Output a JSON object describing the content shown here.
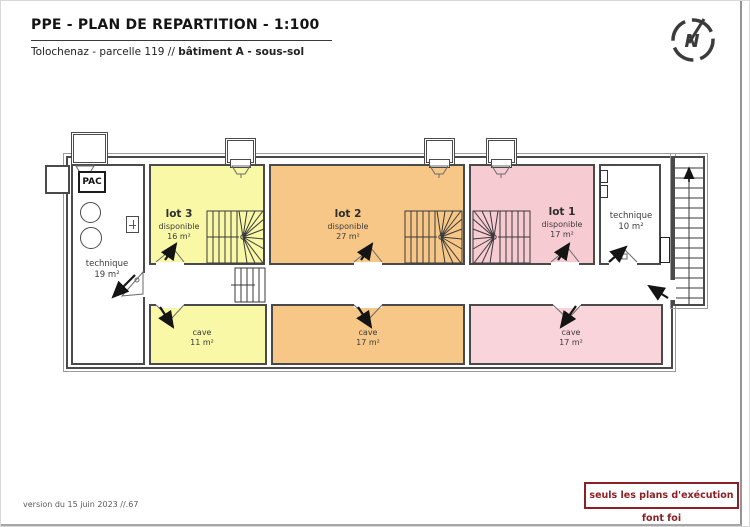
{
  "header": {
    "title": "PPE - PLAN DE REPARTITION - 1:100",
    "subtitle_prefix": "Tolochenaz - parcelle 119 // ",
    "subtitle_bold": "bâtiment A - sous-sol"
  },
  "compass": {
    "letter": "N"
  },
  "plan": {
    "lots": {
      "lot3": {
        "name": "lot 3",
        "status": "disponible",
        "area": "16 m²",
        "color": "#f9f8a6"
      },
      "lot2": {
        "name": "lot 2",
        "status": "disponible",
        "area": "27 m²",
        "color": "#f7c787"
      },
      "lot1": {
        "name": "lot 1",
        "status": "disponible",
        "area": "17 m²",
        "color": "#f7cbd2"
      }
    },
    "rooms": {
      "technique_left": {
        "name": "technique",
        "area": "19 m²"
      },
      "technique_right": {
        "name": "technique",
        "area": "10 m²"
      },
      "cave_lot3": {
        "name": "cave",
        "area": "11 m²"
      },
      "cave_lot2": {
        "name": "cave",
        "area": "17 m²"
      },
      "cave_lot1": {
        "name": "cave",
        "area": "17 m²"
      }
    },
    "equipment": {
      "pac_label": "PAC"
    }
  },
  "footer": {
    "version": "version du 15 juin 2023 //.67",
    "disclaimer": "seuls les plans d'exécution font foi",
    "disclaimer_color": "#8b2025"
  }
}
